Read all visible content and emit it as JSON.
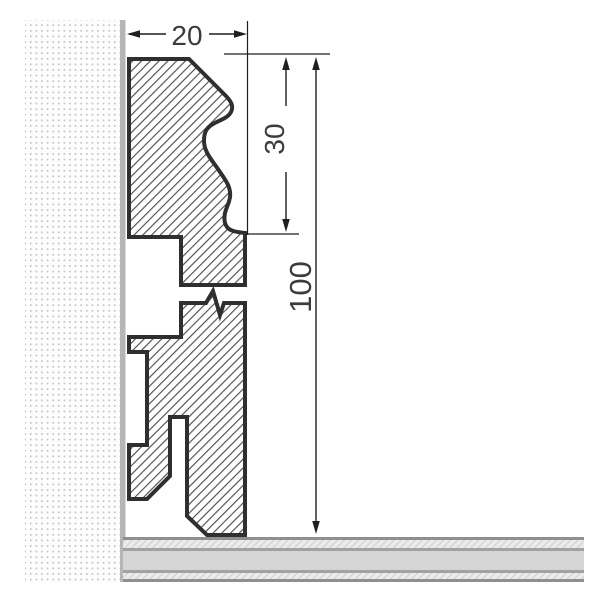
{
  "drawing": {
    "kind": "skirting-board cross-section installation detail",
    "dims": {
      "width": {
        "label": "20"
      },
      "top_section_height": {
        "label": "30"
      },
      "total_height": {
        "label": "100"
      }
    }
  },
  "colors": {
    "outline": "#2f2f2f",
    "hatch_line": "#4f4f4f",
    "dim_line": "#1f1f1f",
    "text": "#3c3c3c",
    "wall_bg": "#fdfdfd",
    "wall_dot": "#c2c2c2",
    "wall_surface": "#b5b5b5",
    "floor_edge_line": "#8f8f8f",
    "floor_mid_line": "#a2a2a2",
    "floor_solid": "#d5d5d5",
    "floor_hatch_bg": "#ebebeb",
    "floor_hatch_line": "#cdcdcd"
  }
}
